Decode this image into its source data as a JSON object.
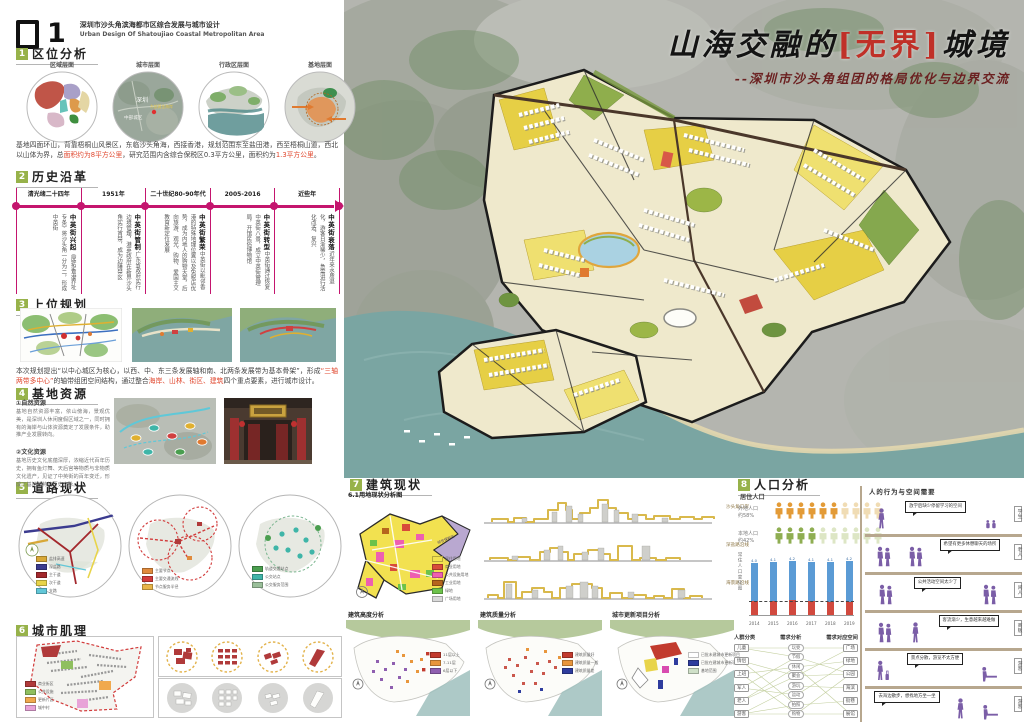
{
  "header": {
    "number": "1",
    "title_cn": "深圳市沙头角滨海都市区综合发展与城市设计",
    "title_en": "Urban Design Of Shatoujiao Coastal Metropolitan Area"
  },
  "poster_title": {
    "pre": "山海交融的",
    "bracket_open": "[",
    "bracket_word": "无界",
    "bracket_close": "]",
    "post": "城境",
    "subtitle": "--深圳市沙头角组团的格局优化与边界交流"
  },
  "s1": {
    "num": "1",
    "title": "区位分析",
    "circles": [
      "区域层面",
      "城市层面",
      "行政区层面",
      "基地层面"
    ],
    "map_labels": {
      "city": "深圳",
      "central": "中部城区",
      "coast": "东部黄金海岸"
    },
    "paragraph": [
      {
        "t": "基地四面环山，背靠梧桐山风景区，东临沙头角海，西接香港，规划范围东至盐田港，西至梧桐山道，西北以山体为界，总"
      },
      {
        "t": "面积约为8平方公里",
        "red": true
      },
      {
        "t": "，研究范围内含综合保税区0.3平方公里，面积约为"
      },
      {
        "t": "1.3平方公里",
        "red": true
      },
      {
        "t": "。"
      }
    ]
  },
  "s2": {
    "num": "2",
    "title": "历史沿革",
    "timeline": [
      {
        "period": "清光绪二十四年",
        "name": "中英街兴起",
        "desc": "《展拓香港界址专条》将沙头角一分为二，形成中英街"
      },
      {
        "period": "1951年",
        "name": "中英街管制",
        "desc": "广东省政府实行边境管理，港英政府在新界沙头角实行宵禁，成为边陲禁区"
      },
      {
        "period": "二十世纪80-90年代",
        "name": "中英街繁荣",
        "desc": "中英街以毗邻香港的特殊地理位置以及免税店优势，成为内地人的购物天堂，后向旅游、观光、购物、爱国主义教育新定位发展"
      },
      {
        "period": "2005-2016",
        "name": "中英街转型",
        "desc": "中英街通过恢复中英街八景，成立中英街管理局，开馆民俗博物馆"
      },
      {
        "period": "近些年",
        "name": "中英街衰落",
        "desc": "近年来水质退化，游客日渐稀少，急需进行活化改造、复兴"
      }
    ]
  },
  "s3": {
    "num": "3",
    "title": "上位规划",
    "paragraph": [
      {
        "t": "本次规划提出“以中心城区为核心，以西、中、东三条发展轴和南、北两条发展带为基本骨架”，形成"
      },
      {
        "t": "“三轴两带多中心”",
        "red": true
      },
      {
        "t": "的轴带组团空间结构，通过整合"
      },
      {
        "t": "海岸、山林、街区、建筑",
        "red": true
      },
      {
        "t": "四个重点要素，进行城市设计。"
      }
    ]
  },
  "s4": {
    "num": "4",
    "title": "基地资源",
    "items": [
      {
        "label": "①自然资源",
        "text": "基地自然资源丰富，依山傍海，景观优美，是深圳人休闲度假区域之一，同时拥有的海岸与山体资源奠定了发展条件，助推产业发展转向。"
      },
      {
        "label": "②文化资源",
        "text": "基地历史文化底蕴深厚，浓缩近代百年历史，拥有鱼灯舞、天后宫等物质与非物质文化遗产，见证了中英街的百年变迁，形成了基地独特的历史文脉。"
      }
    ]
  },
  "s5": {
    "num": "5",
    "title": "道路现状",
    "legends": [
      [
        {
          "c": "#d8a837",
          "t": "盐排高速"
        },
        {
          "c": "#3b3b8f",
          "t": "深盐路"
        },
        {
          "c": "#a3282d",
          "t": "主干道"
        },
        {
          "c": "#e8d44a",
          "t": "次干道"
        },
        {
          "c": "#62c7d8",
          "t": "支路"
        }
      ],
      [
        {
          "c": "#e08a3c",
          "t": "主要节点"
        },
        {
          "c": "#d23b3b",
          "t": "主要交通流线"
        },
        {
          "c": "#e8b64a",
          "t": "节点服务半径"
        }
      ],
      [
        {
          "c": "#4a9e4f",
          "t": "轨道交通站点"
        },
        {
          "c": "#3fb5a8",
          "t": "公交站点"
        },
        {
          "c": "#9abf9a",
          "t": "公交服务范围"
        }
      ]
    ]
  },
  "s6": {
    "num": "6",
    "title": "城市肌理",
    "legend": [
      {
        "c": "#b03a3a",
        "t": "商业街区"
      },
      {
        "c": "#8fbf5f",
        "t": "公共设施"
      },
      {
        "c": "#f0a94e",
        "t": "更新片区"
      },
      {
        "c": "#e8a3d8",
        "t": "城中村"
      }
    ]
  },
  "s7": {
    "num": "7",
    "title": "建筑现状",
    "map_label": "6.1用地现状分析图",
    "bonded_zone": "综合保税区",
    "landuse_legend": [
      {
        "c": "#f2e150",
        "t": "居住用地"
      },
      {
        "c": "#d84b3a",
        "t": "商业用地"
      },
      {
        "c": "#ee5fb0",
        "t": "公共设施用地"
      },
      {
        "c": "#b5651d",
        "t": "工业用地"
      },
      {
        "c": "#6cc24a",
        "t": "绿地"
      },
      {
        "c": "#d9d9d9",
        "t": "广场用地"
      }
    ],
    "elevations": [
      "沙头角口岸",
      "深盐路沿线",
      "海景路沿线"
    ],
    "analyses": [
      {
        "title": "建筑高度分析",
        "legend": [
          {
            "c": "#c23b2e",
            "t": "11层以上"
          },
          {
            "c": "#e8963c",
            "t": "7-11层"
          },
          {
            "c": "#8f5fb0",
            "t": "6层以下"
          }
        ]
      },
      {
        "title": "建筑质量分析",
        "legend": [
          {
            "c": "#c23b2e",
            "t": "建筑质量好"
          },
          {
            "c": "#e8963c",
            "t": "建筑质量一般"
          },
          {
            "c": "#2e3c9e",
            "t": "建筑质量差"
          }
        ]
      },
      {
        "title": "城市更新项目分析",
        "legend": [
          {
            "c": "#ffffff",
            "t": "已批未建城市更新项目"
          },
          {
            "c": "#2e3c9e",
            "t": "已批在建城市更新项目"
          },
          {
            "c": "#cfe0c8",
            "t": "基地范围"
          }
        ]
      }
    ]
  },
  "s8": {
    "num": "8",
    "title": "人口分析",
    "resident_label": "居住人口",
    "picto": [
      {
        "label": "外地人口",
        "pct": "约58%",
        "filled": 6,
        "total": 10,
        "color": "#e39b37",
        "faded": "#f0dcb4"
      },
      {
        "label": "本地人口",
        "pct": "约42%",
        "filled": 4,
        "total": 10,
        "color": "#8fae52",
        "faded": "#dde6c5"
      }
    ],
    "network": {
      "headers": [
        "人群分类",
        "需求分析",
        "需求对应空间"
      ],
      "left": [
        "儿童",
        "情侣",
        "上班",
        "军人",
        "老人",
        "游客"
      ],
      "mid": [
        "玩耍",
        "节假",
        "休闲",
        "聚会",
        "游玩",
        "运动",
        "拍照",
        "购物"
      ],
      "right": [
        "广场",
        "绿地",
        "公园",
        "海滨",
        "街巷",
        "展馆"
      ],
      "links_lm": [
        [
          0,
          0
        ],
        [
          0,
          1
        ],
        [
          1,
          3
        ],
        [
          1,
          6
        ],
        [
          2,
          2
        ],
        [
          2,
          7
        ],
        [
          3,
          1
        ],
        [
          3,
          5
        ],
        [
          4,
          2
        ],
        [
          4,
          3
        ],
        [
          5,
          4
        ],
        [
          5,
          6
        ],
        [
          5,
          7
        ]
      ],
      "links_mr": [
        [
          0,
          0
        ],
        [
          1,
          2
        ],
        [
          2,
          1
        ],
        [
          2,
          5
        ],
        [
          3,
          0
        ],
        [
          3,
          2
        ],
        [
          4,
          3
        ],
        [
          5,
          1
        ],
        [
          6,
          4
        ],
        [
          7,
          2
        ],
        [
          7,
          5
        ]
      ]
    },
    "behavior": {
      "header": "人的行为与空间需要",
      "rows": [
        {
          "tag": "学生",
          "bubble": "放学后缺少停留学习的空间"
        },
        {
          "tag": "老人",
          "bubble": "希望有更多休憩聊天的场所"
        },
        {
          "tag": "闲人",
          "bubble": "公共活动空间太少了"
        },
        {
          "tag": "商贩",
          "bubble": "客流渐少，生意越来越难做"
        },
        {
          "tag": "游客",
          "bubble": "景点分散，游览不太方便"
        },
        {
          "tag": "游客",
          "bubble": "去海边散步，想找地方坐一坐"
        }
      ]
    }
  },
  "chart_data": {
    "type": "bar",
    "title": "常住人口变化图",
    "ylabel": "常住人口变化图",
    "unit": "万人",
    "categories": [
      "2014",
      "2015",
      "2016",
      "2017",
      "2018",
      "2019"
    ],
    "series": [
      {
        "name": "常住人口",
        "color": "#5b9bd5",
        "values": [
          4.0,
          4.1,
          4.2,
          4.1,
          4.1,
          4.2
        ]
      },
      {
        "name": "户籍人口",
        "color": "#d1493e",
        "values": [
          1.1,
          1.1,
          1.2,
          1.1,
          1.0,
          1.0
        ]
      }
    ],
    "ylim": [
      0,
      4.5
    ],
    "grid": false,
    "legend_position": "none"
  }
}
